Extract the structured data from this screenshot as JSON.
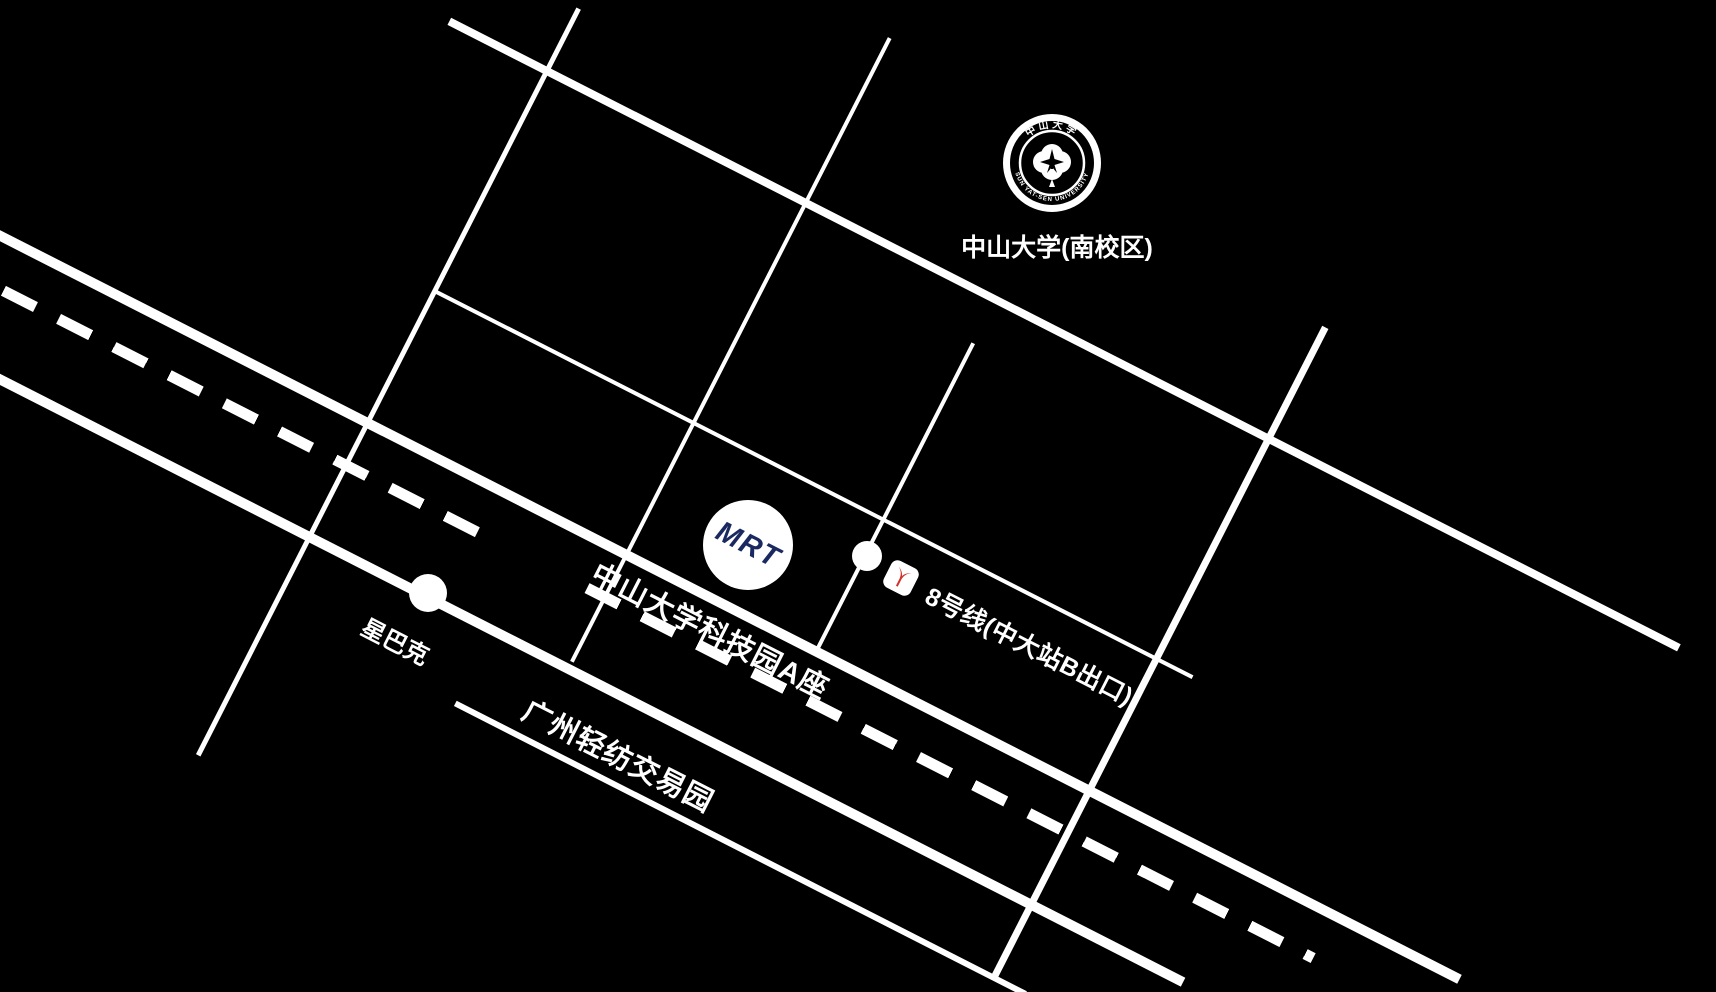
{
  "map_title": "中大科技园区位示意图",
  "colors": {
    "background": "#000000",
    "road": "#ffffff",
    "mrt_logo_text": "#1a2a60",
    "metro_logo_red": "#d3302a"
  },
  "labels": {
    "university": "中山大学(南校区)",
    "tech_park": "中山大学科技园A座",
    "metro_line": "8号线(中大站B出口)",
    "starbucks": "星巴克",
    "textile_park": "广州轻纺交易园",
    "mrt_logo": "MRT"
  },
  "seal": {
    "top_text": "中山大学",
    "bottom_text": "SUN YAT-SEN UNIVERSITY"
  },
  "markers": {
    "mrt_building": "MRT science-park building circle",
    "metro_station": "metro station dot",
    "starbucks_dot": "starbucks dot"
  }
}
